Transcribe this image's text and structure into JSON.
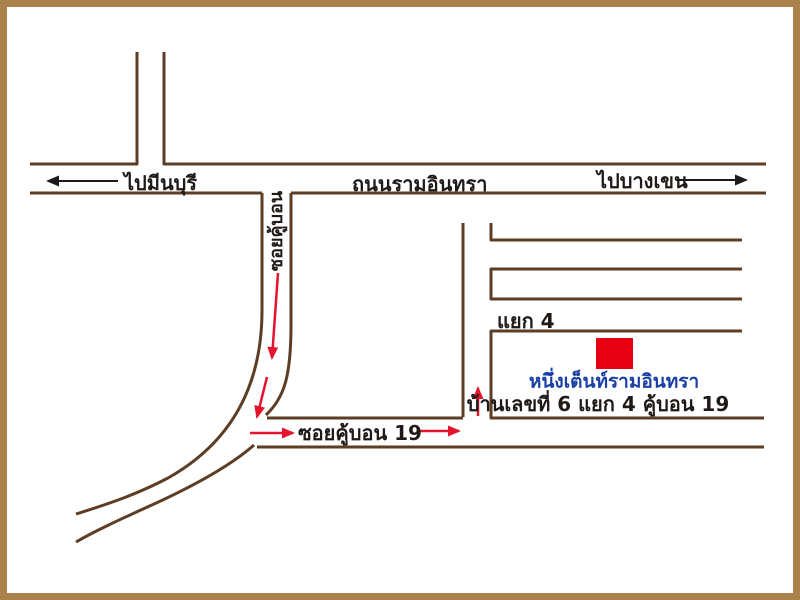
{
  "map": {
    "labels": {
      "to_minburi": "ไปมีนบุรี",
      "road_ramindra": "ถนนรามอินทรา",
      "to_bangkhen": "ไปบางเขน",
      "soi_kubon": "ซอยคู้บอน",
      "soi_kubon_19": "ซอยคู้บอน 19",
      "intersection_4": "แยก 4",
      "place_name": "หนึ่งเต็นท์รามอินทรา",
      "address": "บ้านเลขที่ 6 แยก 4 คู้บอน 19"
    },
    "colors": {
      "frame_border": "#a9814b",
      "road_line": "#5d3d24",
      "route_arrow_red": "#e4132e",
      "direction_arrow_black": "#1a1a1a",
      "location_marker_red": "#e60012",
      "place_name_blue": "#1b3fa5",
      "background": "#ffffff"
    },
    "marker": {
      "type": "red-square",
      "meaning": "location of place on block south of intersection 4"
    }
  }
}
